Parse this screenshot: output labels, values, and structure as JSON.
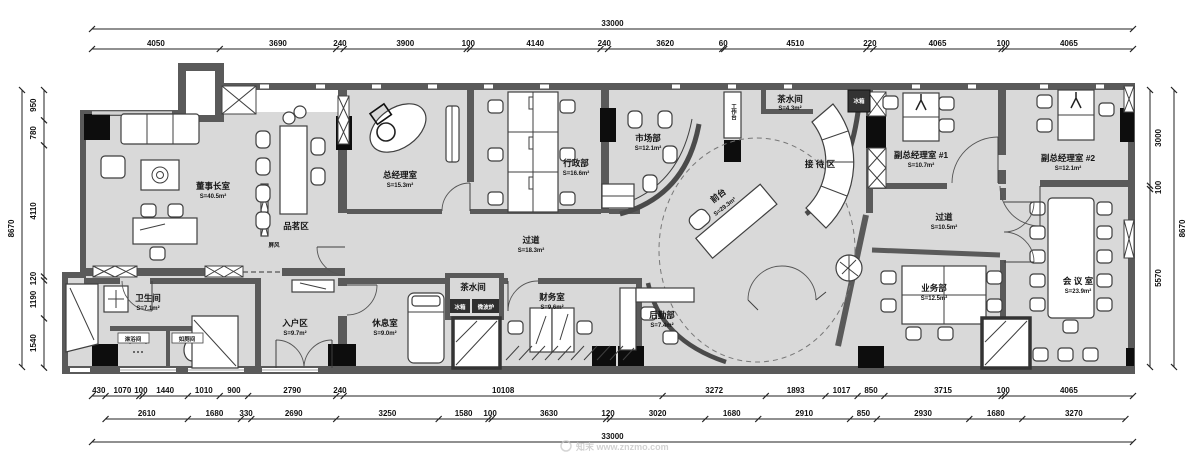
{
  "watermark": "知末 www.znzmo.com",
  "dims": {
    "overall_h": 33000,
    "overall_v": 8670,
    "top": [
      4050,
      3690,
      240,
      3900,
      100,
      4140,
      240,
      3620,
      60,
      4510,
      220,
      4065,
      100,
      4065
    ],
    "bottom1": [
      430,
      1070,
      100,
      1440,
      1010,
      900,
      2790,
      240,
      10108,
      3272,
      1893,
      1017,
      850,
      3715,
      100,
      4065
    ],
    "bottom2": [
      2610,
      1680,
      330,
      2690,
      3250,
      1580,
      100,
      3630,
      120,
      3020,
      1680,
      2910,
      850,
      2930,
      1680,
      3270
    ],
    "bottom2_offset": 430,
    "left": [
      950,
      780,
      4110,
      120,
      1190,
      1540
    ],
    "right": [
      3000,
      100,
      5570
    ]
  },
  "rooms": {
    "chairman": {
      "name": "董事长室",
      "area": "S=40.5m²"
    },
    "tea_tasting": {
      "name": "品茗区"
    },
    "screen": {
      "name": "屏风"
    },
    "bathroom": {
      "name": "卫生间",
      "area": "S=7.1m²"
    },
    "shower": {
      "name": "淋浴间"
    },
    "toilet": {
      "name": "如厕间"
    },
    "entry": {
      "name": "入户区",
      "area": "S=9.7m²"
    },
    "gm": {
      "name": "总经理室",
      "area": "S=15.3m²"
    },
    "admin": {
      "name": "行政部",
      "area": "S=16.6m²"
    },
    "corridor1": {
      "name": "过道",
      "area": "S=18.3m²"
    },
    "lounge": {
      "name": "休息室",
      "area": "S=9.0m²"
    },
    "pantry2": {
      "name": "茶水间"
    },
    "fridge2": {
      "name": "冰箱"
    },
    "microwave": {
      "name": "微波炉"
    },
    "finance": {
      "name": "财务室",
      "area": "S=9.6m²"
    },
    "marketing": {
      "name": "市场部",
      "area": "S=12.1m²"
    },
    "logistics": {
      "name": "后勤部",
      "area": "S=7.4m²"
    },
    "pantry1": {
      "name": "茶水间",
      "area": "S=4.3m²"
    },
    "fridge1": {
      "name": "冰箱"
    },
    "workbench": {
      "name": "工作台"
    },
    "reception": {
      "name": "接 待 区"
    },
    "front_desk": {
      "name": "前台",
      "area": "S=29.3m²"
    },
    "vice_gm1": {
      "name": "副总经理室 #1",
      "area": "S=10.7m²"
    },
    "vice_gm2": {
      "name": "副总经理室 #2",
      "area": "S=12.1m²"
    },
    "corridor2": {
      "name": "过道",
      "area": "S=10.5m²"
    },
    "business": {
      "name": "业务部",
      "area": "S=12.5m²"
    },
    "meeting": {
      "name": "会 议 室",
      "area": "S=23.9m²"
    }
  }
}
